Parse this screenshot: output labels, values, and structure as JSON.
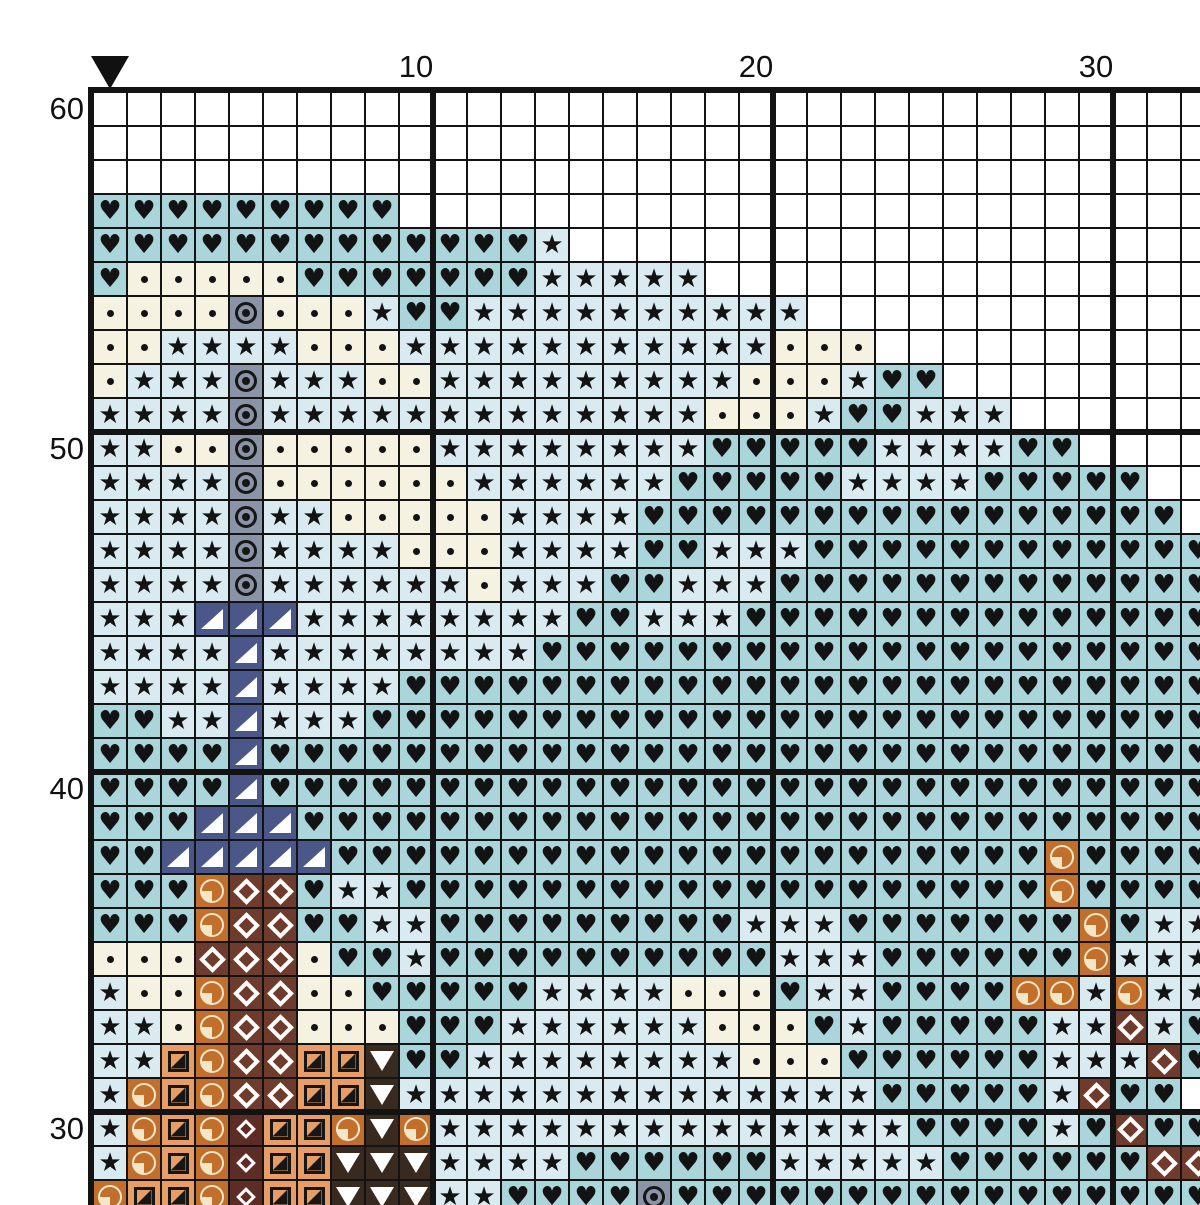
{
  "pattern": {
    "title": "cross-stitch-pattern-chart",
    "start_marker": {
      "symbol": "down-arrow-marker",
      "column": 1
    },
    "row_labels": [
      {
        "text": "60",
        "row": 1
      },
      {
        "text": "50",
        "row": 11
      },
      {
        "text": "40",
        "row": 21
      },
      {
        "text": "30",
        "row": 31
      }
    ],
    "col_labels": [
      {
        "text": "10",
        "col": 10
      },
      {
        "text": "20",
        "col": 20
      },
      {
        "text": "30",
        "col": 30
      }
    ],
    "grid_line_color": "#131313",
    "thick_line_every": 10,
    "legend": {
      "W": {
        "name": "blank",
        "bg": "#ffffff",
        "symbol": "none",
        "glyph": ""
      },
      "H": {
        "name": "heart",
        "bg": "#aad6db",
        "symbol": "glyph",
        "glyph": "♥"
      },
      "S": {
        "name": "star",
        "bg": "#d9eaf1",
        "symbol": "glyph",
        "glyph": "★"
      },
      "D": {
        "name": "dot",
        "bg": "#f6f2e2",
        "symbol": "dot",
        "glyph": "•"
      },
      "O": {
        "name": "circled-dot",
        "bg": "#8b93a7",
        "symbol": "ring-dot",
        "glyph": "⊙"
      },
      "T": {
        "name": "corner-triangle",
        "bg": "#4b5788",
        "symbol": "corner-triangle",
        "glyph": "◢"
      },
      "P": {
        "name": "quarter-pie",
        "bg": "#c16f2b",
        "symbol": "pie",
        "glyph": "◔"
      },
      "M": {
        "name": "diamond-outline",
        "bg": "#6f3b2d",
        "symbol": "diamond-large",
        "glyph": "◇"
      },
      "N": {
        "name": "small-diamond-outline",
        "bg": "#5d2c25",
        "symbol": "diamond-small",
        "glyph": "◇"
      },
      "Q": {
        "name": "half-square",
        "bg": "#e79d63",
        "symbol": "half-square",
        "glyph": "◪"
      },
      "V": {
        "name": "down-triangle",
        "bg": "#392a20",
        "symbol": "down-triangle",
        "glyph": "▼"
      }
    },
    "grid": {
      "visible_columns": 33,
      "visible_rows": 33,
      "rows": [
        "WWWWWWWWWWWWWWWWWWWWWWWWWWWWWWWWW",
        "WWWWWWWWWWWWWWWWWWWWWWWWWWWWWWWWW",
        "WWWWWWWWWWWWWWWWWWWWWWWWWWWWWWWWW",
        "HHHHHHHHHWWWWWWWWWWWWWWWWWWWWWWWW",
        "HHHHHHHHHHHHHSWWWWWWWWWWWWWWWWWWW",
        "HDDDDDHHHHHHHSSSSSWWWWWWWWWWWWWWW",
        "DDDDODDDSHHSSSSSSSSSSWWWWWWWWWWWW",
        "DDSSSSDDDSSSSSSSSSSSDDDWWWWWWWWWW",
        "DSSSOSSSDDSSSSSSSSSDDDSHHWWWWWWWW",
        "SSSSOSSSSSSSSSSSSSDDDSHHSSSWWWWWW",
        "SSDDODDDDDSSSSSSSSHHHHHSSSSHHWWWW",
        "SSSSODDDDDDSSSSSSHHHHHSSSSHHHHHWW",
        "SSSSOSSDDDDDSSSSHHHHHHHHHHHHHHHHW",
        "SSSSOSSSSDDDSSSSHHSSSHHHHHHHHHHHH",
        "SSSSOSSSSSSDSSSHHSSSHHHHHHHHHHHHH",
        "SSSTTTSSSSSSSSHHSSSHHHHHHHHHHHHHH",
        "SSSSTSSSSSSSSHHHHHHHHHHHHHHHHHHHH",
        "SSSSTSSSSHHHHHHHHHHHHHHHHHHHHHHHH",
        "HHSSTSSSHHHHHHHHHHHHHHHHHHHHHHHHH",
        "HHHHTHHHHHHHHHHHHHHHHHHHHHHHHHHHH",
        "HHHHTHHHHHHHHHHHHHHHHHHHHHHHHHHHH",
        "HHHTTTHHHHHHHHHHHHHHHHHHHHHHHHHHH",
        "HHTTTTTHHHHHHHHHHHHHHHHHHHHHPHHHH",
        "HHHPMMHSSHHHHHHHHHHHHHHHHHHHPHHHH",
        "HHHPMMHHSSHHHHHHHHHSSSHHHHHHHPHSS",
        "DDDMMMDHHSHHHHHHHHHHSSSHHHHHHPSSS",
        "SDDPMMDDHHHHHSSSSDDDHSSHHHHPPSPSS",
        "SSDPMMDDDHHHSSSSSSDDDHSHHHHHSSMSH",
        "SSQPMMQQVHHSSSSSSSSDDDHHHHHHSSSMH",
        "SPQPMMQQVSSSSSSSSSSSSSSHHHHHSMHHW",
        "SPQPNQQPVPSSSSSSSSSSSSSSHHHHSHMHH",
        "SPQPNQQVVVSSSSHHHHHHSSSSSHHHHHHMM",
        "PQQPNQQVVVSSHHHHOHHHHHHHHHHHHHHHH"
      ]
    }
  }
}
